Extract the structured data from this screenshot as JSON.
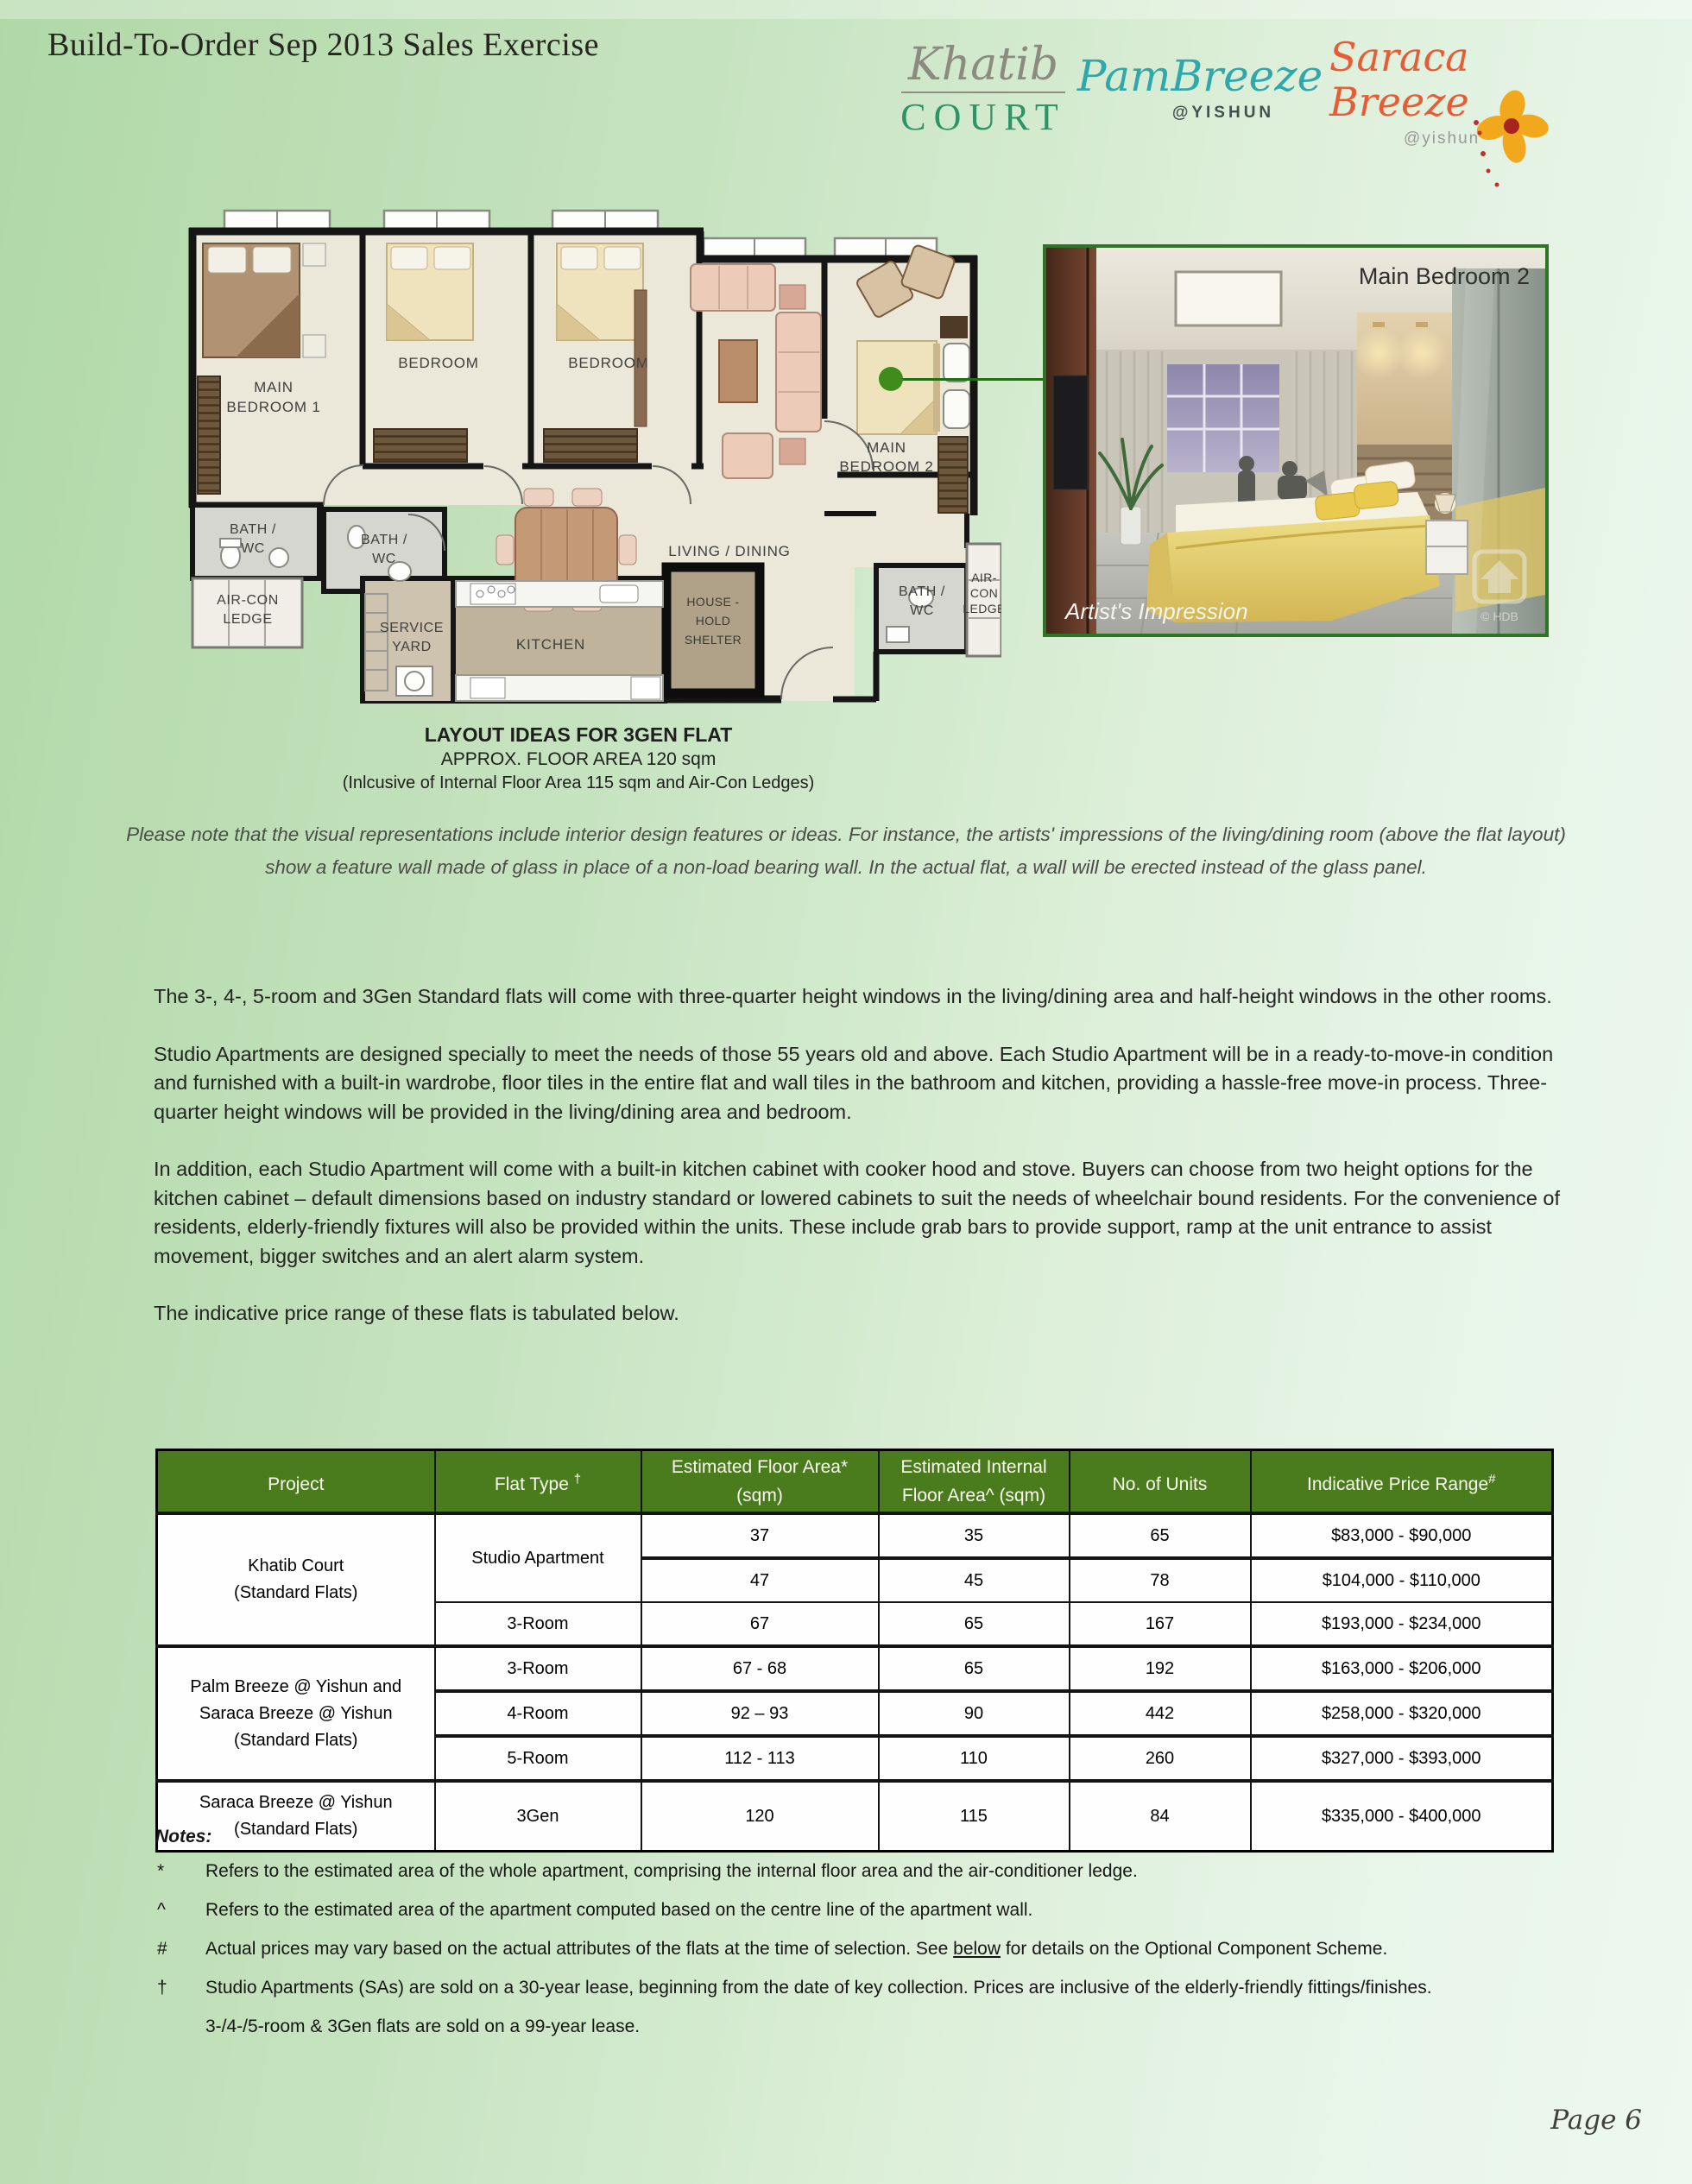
{
  "header": {
    "title": "Build-To-Order Sep 2013 Sales Exercise"
  },
  "logos": {
    "khatib": {
      "script": "Khatib",
      "caps": "COURT"
    },
    "palm": {
      "script_left": "Pa",
      "script_right": "mBreeze",
      "sub": "@YISHUN"
    },
    "saraca": {
      "script": "Saraca Breeze",
      "sub": "@yishun"
    }
  },
  "floorplan": {
    "labels": {
      "main_bedroom_1": [
        "MAIN",
        "BEDROOM 1"
      ],
      "bedroom_a": "BEDROOM",
      "bedroom_b": "BEDROOM",
      "main_bedroom_2": [
        "MAIN",
        "BEDROOM 2"
      ],
      "living": "LIVING / DINING",
      "bath_1": [
        "BATH /",
        "WC"
      ],
      "bath_2": [
        "BATH /",
        "WC"
      ],
      "bath_3": [
        "BATH /",
        "WC"
      ],
      "aircon_left": [
        "AIR-CON",
        "LEDGE"
      ],
      "aircon_right": [
        "AIR-",
        "CON",
        "LEDGE"
      ],
      "service_yard": [
        "SERVICE",
        "YARD"
      ],
      "kitchen": "KITCHEN",
      "household_shelter": [
        "HOUSE -",
        "HOLD",
        "SHELTER"
      ]
    }
  },
  "photo": {
    "title": "Main Bedroom 2",
    "caption": "Artist's Impression",
    "watermark": "© HDB"
  },
  "plan_caption": {
    "line1": "LAYOUT IDEAS FOR 3GEN FLAT",
    "line2": "APPROX. FLOOR AREA 120 sqm",
    "line3": "(Inlcusive of Internal Floor Area 115 sqm and Air-Con Ledges)"
  },
  "italic_note": "Please note that the visual representations include interior design features or ideas. For instance, the artists' impressions of the living/dining room (above the flat layout) show a feature wall made of glass in place of a non-load bearing wall. In the actual flat, a wall will be erected instead of the glass panel.",
  "paragraphs": [
    "The 3-, 4-, 5-room and 3Gen Standard flats will come with three-quarter height windows in the living/dining area and half-height windows in the other rooms.",
    "Studio Apartments are designed specially to meet the needs of those 55 years old and above. Each Studio Apartment will be in a ready-to-move-in condition and furnished with a built-in wardrobe, floor tiles in the entire flat and wall tiles in the bathroom and kitchen, providing a hassle-free move-in process. Three-quarter height windows will be provided in the living/dining area and bedroom.",
    "In addition, each Studio Apartment will come with a built-in kitchen cabinet with cooker hood and stove. Buyers can choose from two height options for the kitchen cabinet – default dimensions based on industry standard or lowered cabinets to suit the needs of wheelchair bound residents. For the convenience of residents, elderly-friendly fixtures will also be provided within the units. These include grab bars to provide support, ramp at the unit entrance to assist movement, bigger switches and an alert alarm system.",
    "The indicative price range of these flats is tabulated below."
  ],
  "table": {
    "headers": [
      {
        "label": "Project",
        "sup": ""
      },
      {
        "label": "Flat Type ",
        "sup": "†"
      },
      {
        "label": "Estimated Floor Area* (sqm)",
        "sup": ""
      },
      {
        "label": "Estimated Internal Floor Area^ (sqm)",
        "sup": ""
      },
      {
        "label": "No. of Units",
        "sup": ""
      },
      {
        "label": "Indicative Price Range",
        "sup": "#"
      }
    ],
    "rows": [
      {
        "project": "Khatib Court\n(Standard Flats)",
        "flat": "Studio Apartment",
        "floor": "37",
        "internal": "35",
        "units": "65",
        "price": "$83,000 - $90,000"
      },
      {
        "floor": "47",
        "internal": "45",
        "units": "78",
        "price": "$104,000 - $110,000"
      },
      {
        "flat": "3-Room",
        "floor": "67",
        "internal": "65",
        "units": "167",
        "price": "$193,000 - $234,000"
      },
      {
        "project": "Palm Breeze @ Yishun and\nSaraca Breeze @ Yishun\n(Standard Flats)",
        "flat": "3-Room",
        "floor": "67 - 68",
        "internal": "65",
        "units": "192",
        "price": "$163,000 - $206,000"
      },
      {
        "flat": "4-Room",
        "floor": "92 – 93",
        "internal": "90",
        "units": "442",
        "price": "$258,000 - $320,000"
      },
      {
        "flat": "5-Room",
        "floor": "112 - 113",
        "internal": "110",
        "units": "260",
        "price": "$327,000 - $393,000"
      },
      {
        "project": "Saraca Breeze @ Yishun\n(Standard Flats)",
        "flat": "3Gen",
        "floor": "120",
        "internal": "115",
        "units": "84",
        "price": "$335,000 - $400,000"
      }
    ]
  },
  "notes": {
    "title": "Notes:",
    "items": [
      {
        "sym": "*",
        "text": "Refers to the estimated area of the whole apartment, comprising the internal floor area and the air-conditioner ledge."
      },
      {
        "sym": "^",
        "text": "Refers to the estimated area of the apartment computed based on the centre line of the apartment wall."
      },
      {
        "sym": "#",
        "pre": "Actual prices may vary based on the actual attributes of the flats at the time of selection. See ",
        "link": "below",
        "post": " for details on the Optional Component Scheme."
      },
      {
        "sym": "†",
        "text": "Studio Apartments (SAs) are sold on a 30-year lease, beginning from the date of key collection. Prices are inclusive of the elderly-friendly fittings/finishes."
      },
      {
        "sym": "",
        "text": "3-/4-/5-room & 3Gen flats are sold on a 99-year lease."
      }
    ]
  },
  "footer": {
    "page_number": "Page 6"
  }
}
